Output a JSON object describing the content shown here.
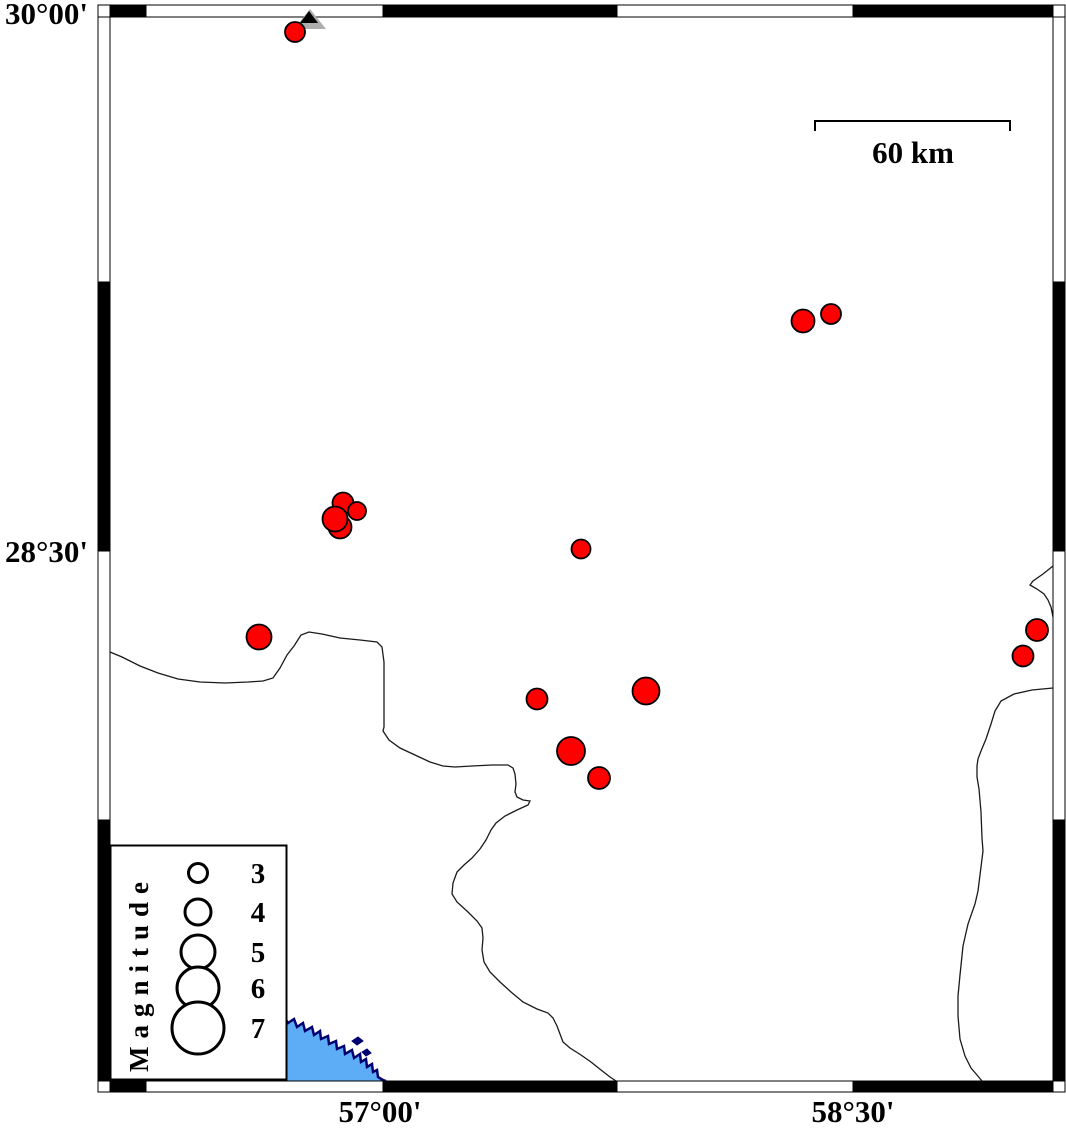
{
  "map": {
    "axes": {
      "lat_labels": [
        "30°00'",
        "28°30'"
      ],
      "lon_labels": [
        "57°00'",
        "58°30'"
      ]
    },
    "scale_bar": {
      "label": "60 km",
      "x1": 815,
      "x2": 1010,
      "y": 121,
      "tick_drop": 10,
      "label_x": 913,
      "label_y": 163
    },
    "legend": {
      "title": "Magnitude",
      "circle_cx": 198,
      "label_x": 258,
      "entries": [
        {
          "label": "3",
          "cy": 873,
          "r": 9.5
        },
        {
          "label": "4",
          "cy": 912,
          "r": 13
        },
        {
          "label": "5",
          "cy": 952,
          "r": 17
        },
        {
          "label": "6",
          "cy": 988,
          "r": 21
        },
        {
          "label": "7",
          "cy": 1028,
          "r": 26
        }
      ]
    },
    "colors": {
      "epicenter_fill": "#FF0000",
      "water": "#5CADF5",
      "coastline": "#000070",
      "boundary": "#1a1a1a",
      "station_gray": "#ADADAD",
      "frame_black": "#000000"
    },
    "earthquakes": [
      {
        "x": 295,
        "y": 32,
        "r": 10
      },
      {
        "x": 831,
        "y": 314,
        "r": 10
      },
      {
        "x": 803,
        "y": 321,
        "r": 11.5
      },
      {
        "x": 343,
        "y": 503,
        "r": 10.5
      },
      {
        "x": 340,
        "y": 527,
        "r": 11.5
      },
      {
        "x": 335,
        "y": 519,
        "r": 12.5
      },
      {
        "x": 357,
        "y": 511,
        "r": 9
      },
      {
        "x": 581,
        "y": 549,
        "r": 9.5
      },
      {
        "x": 259,
        "y": 637,
        "r": 12.5
      },
      {
        "x": 1037,
        "y": 630,
        "r": 11
      },
      {
        "x": 1023,
        "y": 656,
        "r": 10.5
      },
      {
        "x": 537,
        "y": 699,
        "r": 10.5
      },
      {
        "x": 646,
        "y": 691,
        "r": 13.5
      },
      {
        "x": 571,
        "y": 751,
        "r": 14
      },
      {
        "x": 599,
        "y": 778,
        "r": 11
      }
    ],
    "station": {
      "outer": [
        [
          310,
          9
        ],
        [
          294,
          29
        ],
        [
          326,
          29
        ]
      ],
      "inner": [
        [
          309,
          11
        ],
        [
          300,
          23
        ],
        [
          318,
          23
        ]
      ]
    },
    "boundaries": [
      [
        [
          110,
          652
        ],
        [
          122,
          657
        ],
        [
          140,
          666
        ],
        [
          158,
          673
        ],
        [
          178,
          679
        ],
        [
          200,
          682
        ],
        [
          225,
          683
        ],
        [
          248,
          682
        ],
        [
          263,
          681
        ],
        [
          273,
          678
        ],
        [
          280,
          668
        ],
        [
          287,
          655
        ],
        [
          294,
          646
        ],
        [
          301,
          635
        ],
        [
          309,
          632
        ],
        [
          322,
          634
        ],
        [
          340,
          638
        ],
        [
          360,
          640
        ],
        [
          377,
          642
        ],
        [
          382,
          647
        ],
        [
          384,
          662
        ],
        [
          384,
          727
        ],
        [
          383,
          731
        ],
        [
          389,
          740
        ],
        [
          400,
          748
        ],
        [
          415,
          755
        ],
        [
          430,
          762
        ],
        [
          443,
          766
        ],
        [
          455,
          767
        ],
        [
          472,
          766
        ],
        [
          492,
          765
        ],
        [
          508,
          765
        ],
        [
          513,
          768
        ],
        [
          515,
          774
        ],
        [
          516,
          784
        ],
        [
          515,
          792
        ],
        [
          517,
          797
        ],
        [
          523,
          800
        ],
        [
          530,
          801
        ],
        [
          528,
          805
        ],
        [
          517,
          810
        ],
        [
          505,
          816
        ],
        [
          496,
          823
        ],
        [
          491,
          830
        ],
        [
          486,
          840
        ],
        [
          480,
          849
        ],
        [
          472,
          858
        ],
        [
          464,
          865
        ],
        [
          457,
          872
        ],
        [
          453,
          883
        ],
        [
          452,
          894
        ],
        [
          457,
          902
        ],
        [
          468,
          912
        ],
        [
          477,
          921
        ],
        [
          482,
          928
        ],
        [
          483,
          938
        ],
        [
          482,
          950
        ],
        [
          484,
          962
        ],
        [
          490,
          972
        ],
        [
          500,
          982
        ],
        [
          511,
          992
        ],
        [
          523,
          1002
        ],
        [
          537,
          1009
        ],
        [
          548,
          1013
        ],
        [
          553,
          1018
        ],
        [
          557,
          1026
        ],
        [
          560,
          1034
        ],
        [
          563,
          1042
        ],
        [
          570,
          1048
        ],
        [
          581,
          1055
        ],
        [
          591,
          1062
        ],
        [
          601,
          1070
        ],
        [
          610,
          1077
        ],
        [
          616,
          1081
        ]
      ],
      [
        [
          1053,
          566
        ],
        [
          1043,
          574
        ],
        [
          1033,
          581
        ],
        [
          1030,
          585
        ],
        [
          1037,
          589
        ],
        [
          1044,
          594
        ],
        [
          1048,
          600
        ],
        [
          1051,
          607
        ],
        [
          1053,
          617
        ]
      ],
      [
        [
          1053,
          688
        ],
        [
          1032,
          690
        ],
        [
          1014,
          694
        ],
        [
          1001,
          701
        ],
        [
          995,
          711
        ],
        [
          991,
          724
        ],
        [
          986,
          739
        ],
        [
          981,
          751
        ],
        [
          978,
          759
        ],
        [
          977,
          766
        ],
        [
          977,
          777
        ],
        [
          979,
          789
        ],
        [
          981,
          812
        ],
        [
          982,
          838
        ],
        [
          983,
          851
        ],
        [
          981,
          867
        ],
        [
          978,
          891
        ],
        [
          975,
          904
        ],
        [
          968,
          924
        ],
        [
          963,
          946
        ],
        [
          960,
          975
        ],
        [
          958,
          996
        ],
        [
          958,
          1016
        ],
        [
          960,
          1039
        ],
        [
          965,
          1056
        ],
        [
          971,
          1068
        ],
        [
          977,
          1075
        ],
        [
          982,
          1081
        ]
      ]
    ],
    "water": {
      "coastline": [
        [
          284,
          1017
        ],
        [
          288,
          1023
        ],
        [
          294,
          1019
        ],
        [
          297,
          1027
        ],
        [
          303,
          1023
        ],
        [
          305,
          1031
        ],
        [
          312,
          1027
        ],
        [
          314,
          1035
        ],
        [
          320,
          1031
        ],
        [
          321,
          1039
        ],
        [
          328,
          1036
        ],
        [
          329,
          1044
        ],
        [
          336,
          1041
        ],
        [
          337,
          1049
        ],
        [
          344,
          1046
        ],
        [
          345,
          1054
        ],
        [
          352,
          1050
        ],
        [
          354,
          1058
        ],
        [
          360,
          1054
        ],
        [
          361,
          1062
        ],
        [
          366,
          1059
        ],
        [
          367,
          1067
        ],
        [
          372,
          1064
        ],
        [
          373,
          1072
        ],
        [
          377,
          1070
        ],
        [
          378,
          1077
        ],
        [
          383,
          1080
        ],
        [
          386,
          1081
        ]
      ],
      "islands": [
        [
          [
            352,
            1041
          ],
          [
            358,
            1037
          ],
          [
            363,
            1041
          ],
          [
            357,
            1045
          ]
        ],
        [
          [
            362,
            1052
          ],
          [
            367,
            1049
          ],
          [
            371,
            1053
          ],
          [
            366,
            1056
          ]
        ]
      ],
      "polygon_close": [
        [
          386,
          1081
        ],
        [
          270,
          1081
        ],
        [
          270,
          1021
        ]
      ]
    },
    "frame": {
      "x1": 98,
      "y1": 5,
      "x2": 1065,
      "y2": 1092,
      "ix1": 110,
      "iy1": 17,
      "ix2": 1053,
      "iy2": 1081,
      "top_black": [
        [
          110,
          146
        ],
        [
          383,
          617
        ],
        [
          853,
          1053
        ]
      ],
      "bottom_black": [
        [
          110,
          146
        ],
        [
          383,
          617
        ],
        [
          853,
          1053
        ]
      ],
      "left_black": [
        [
          282,
          551
        ],
        [
          820,
          1081
        ]
      ],
      "right_black": [
        [
          282,
          551
        ],
        [
          820,
          1081
        ]
      ]
    }
  }
}
